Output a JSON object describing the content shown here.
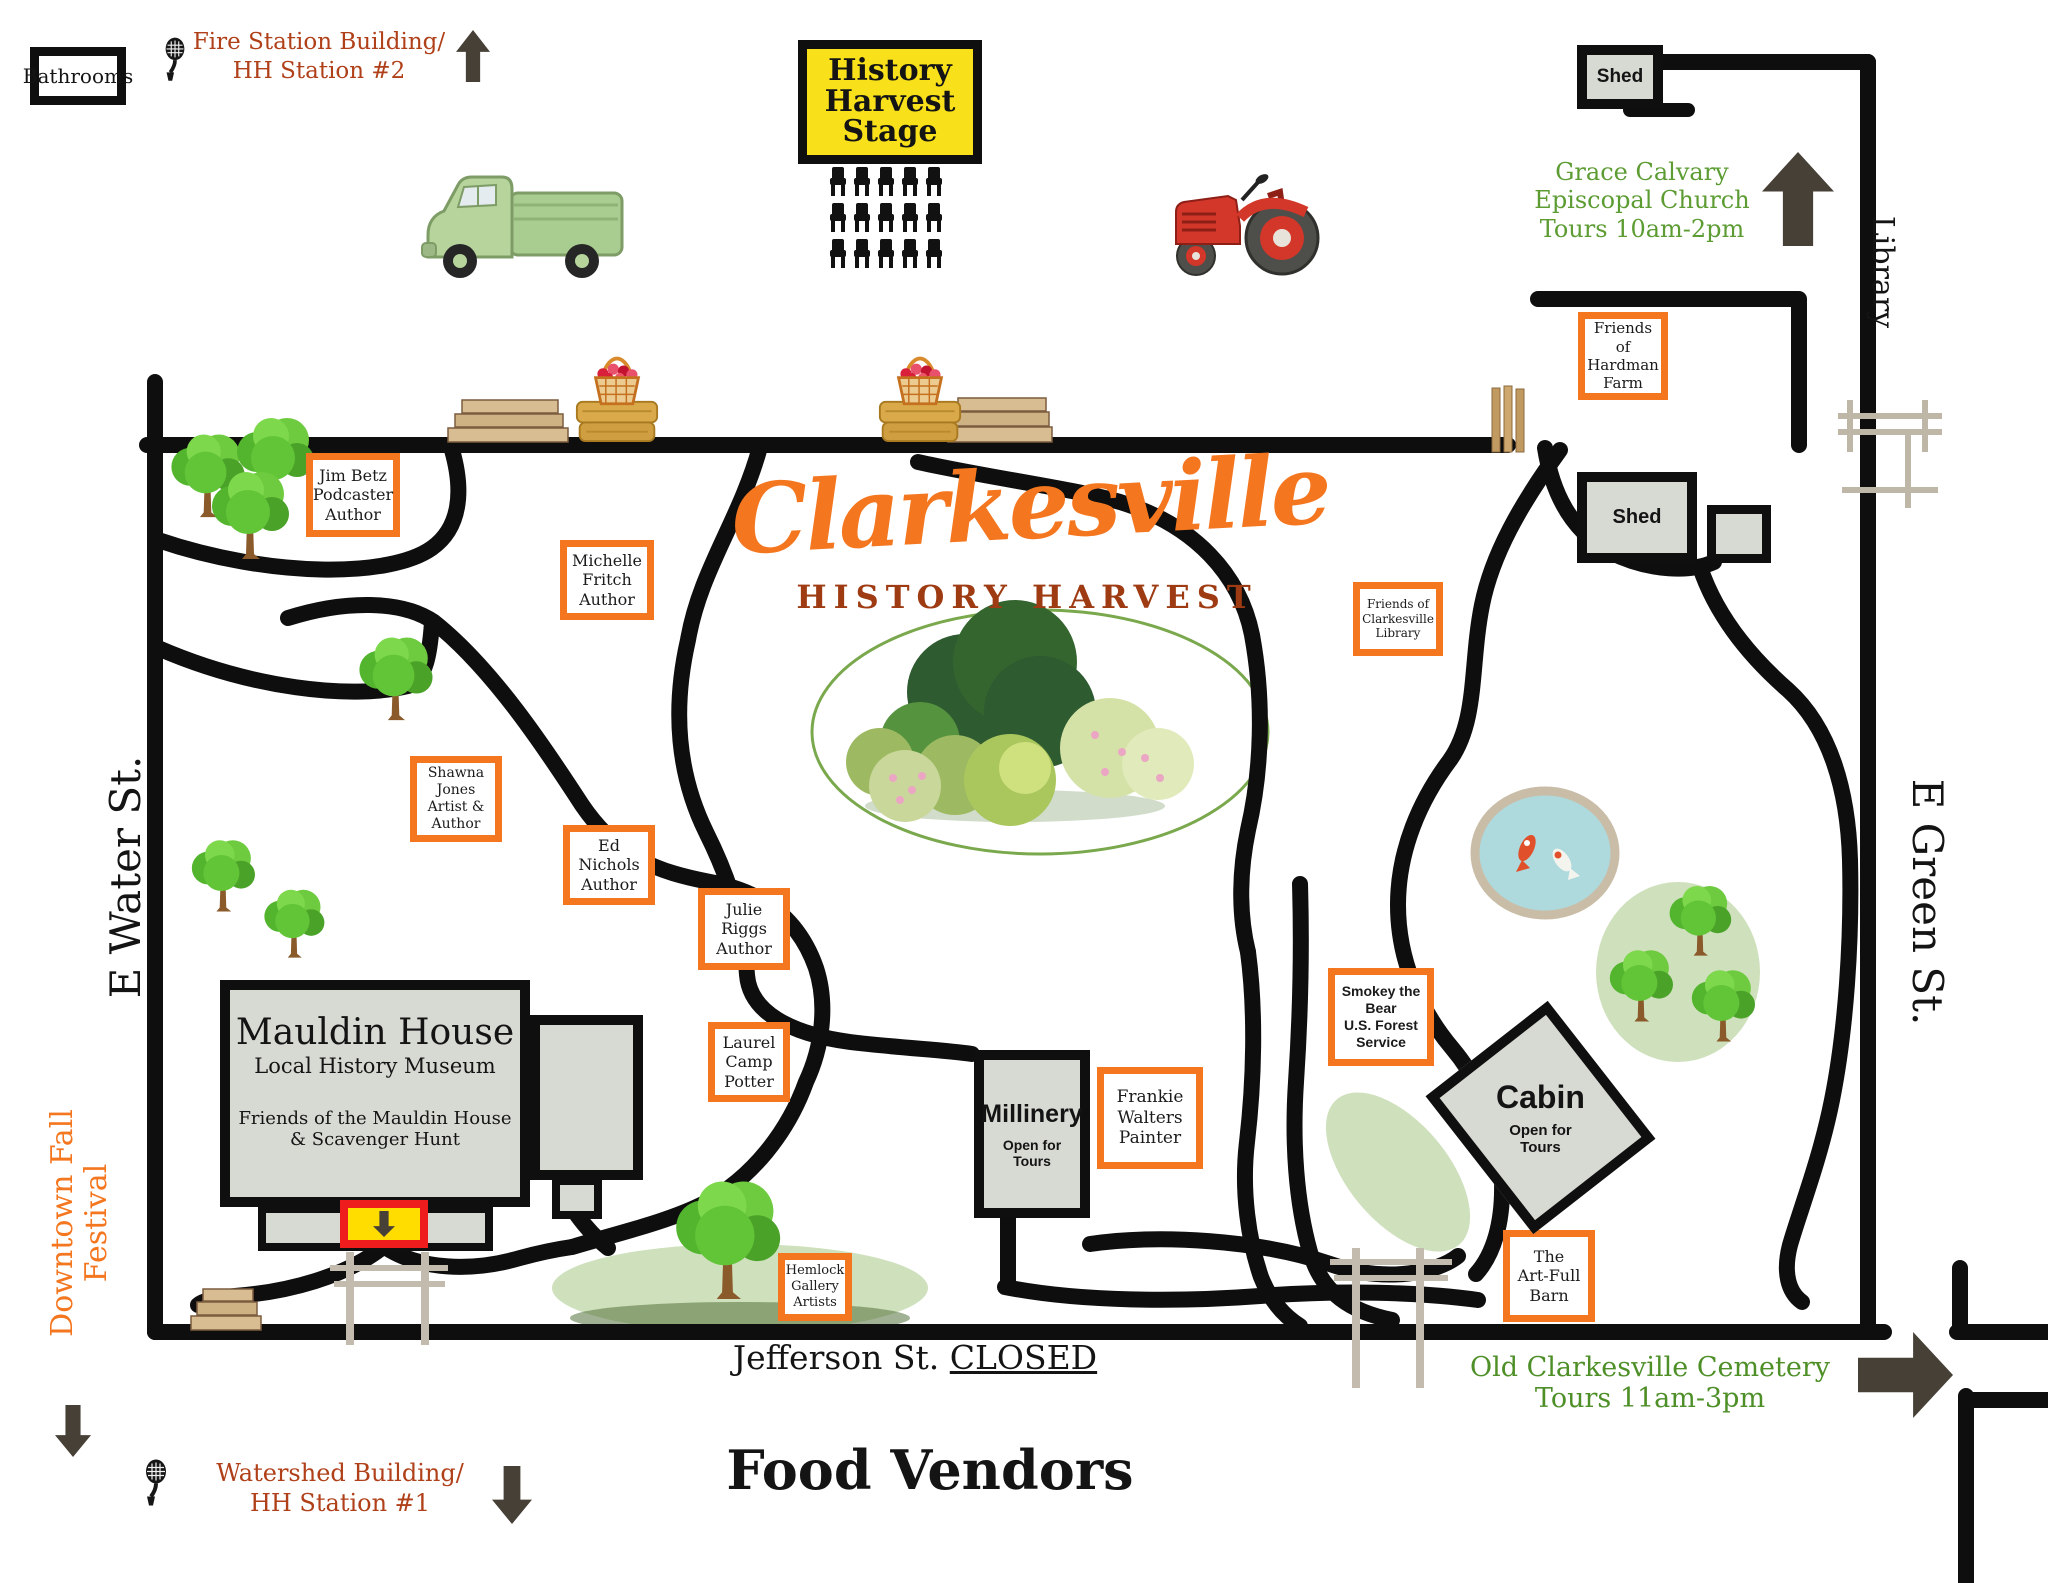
{
  "title": {
    "main": "Clarkesville",
    "subtitle": "HISTORY HARVEST"
  },
  "streets": {
    "e_water": "E Water St.",
    "e_green": "E Green St.",
    "library": "Library",
    "jefferson": "Jefferson St.",
    "jefferson_status": "CLOSED"
  },
  "areas": {
    "food_vendors": "Food Vendors",
    "downtown_line1": "Downtown Fall",
    "downtown_line2": "Festival"
  },
  "stations": {
    "fire": {
      "line1": "Fire Station Building/",
      "line2": "HH Station #2"
    },
    "watershed": {
      "line1": "Watershed Building/",
      "line2": "HH Station #1"
    }
  },
  "tours": {
    "church": {
      "line1": "Grace Calvary",
      "line2": "Episcopal Church",
      "line3": "Tours 10am-2pm"
    },
    "cemetery": {
      "line1": "Old Clarkesville Cemetery",
      "line2": "Tours 11am-3pm"
    }
  },
  "facilities": {
    "bathrooms": "Bathrooms",
    "stage_line1": "History",
    "stage_line2": "Harvest",
    "stage_line3": "Stage",
    "shed_top": "Shed",
    "shed_mid": "Shed"
  },
  "buildings": {
    "mauldin": {
      "name": "Mauldin House",
      "type": "Local History Museum",
      "note1": "Friends of the Mauldin House",
      "note2": "& Scavenger Hunt"
    },
    "millinery": {
      "name": "Millinery",
      "open1": "Open for",
      "open2": "Tours"
    },
    "cabin": {
      "name": "Cabin",
      "open1": "Open for",
      "open2": "Tours"
    }
  },
  "vendors": {
    "jim_betz": [
      "Jim Betz",
      "Podcaster",
      "Author"
    ],
    "michelle_fritch": [
      "Michelle",
      "Fritch",
      "Author"
    ],
    "shawna_jones": [
      "Shawna",
      "Jones",
      "Artist &",
      "Author"
    ],
    "ed_nichols": [
      "Ed",
      "Nichols",
      "Author"
    ],
    "julie_riggs": [
      "Julie",
      "Riggs",
      "Author"
    ],
    "laurel_camp": [
      "Laurel",
      "Camp",
      "Potter"
    ],
    "hemlock": [
      "Hemlock",
      "Gallery",
      "Artists"
    ],
    "hardman": [
      "Friends of",
      "Hardman",
      "Farm"
    ],
    "clarkesville_library": [
      "Friends of",
      "Clarkesville",
      "Library"
    ],
    "smokey": [
      "Smokey the",
      "Bear",
      "U.S. Forest",
      "Service"
    ],
    "frankie_walters": [
      "Frankie",
      "Walters",
      "Painter"
    ],
    "artfull_barn": [
      "The",
      "Art-Full",
      "Barn"
    ]
  },
  "icons": {
    "microphone_station_2": "vintage-microphone",
    "microphone_station_1": "vintage-microphone",
    "fire_station_arrow": "up-arrow",
    "church_arrow": "up-arrow",
    "downtown_arrow": "down-arrow",
    "watershed_arrow": "down-arrow",
    "cemetery_arrow": "right-arrow",
    "mauldin_entrance_arrow": "down-arrow"
  },
  "colors": {
    "accent_orange": "#F4761F",
    "road_black": "#0E0E0E",
    "building_gray": "#D7D9D3",
    "stage_yellow": "#F8E11A",
    "entrance_yellow": "#FFDD00",
    "entrance_red": "#EE1C1C",
    "station_text_red": "#B04019",
    "tour_text_green": "#5C9C33",
    "subtitle_brown": "#9E3B12",
    "arrow_dark": "#474037"
  }
}
